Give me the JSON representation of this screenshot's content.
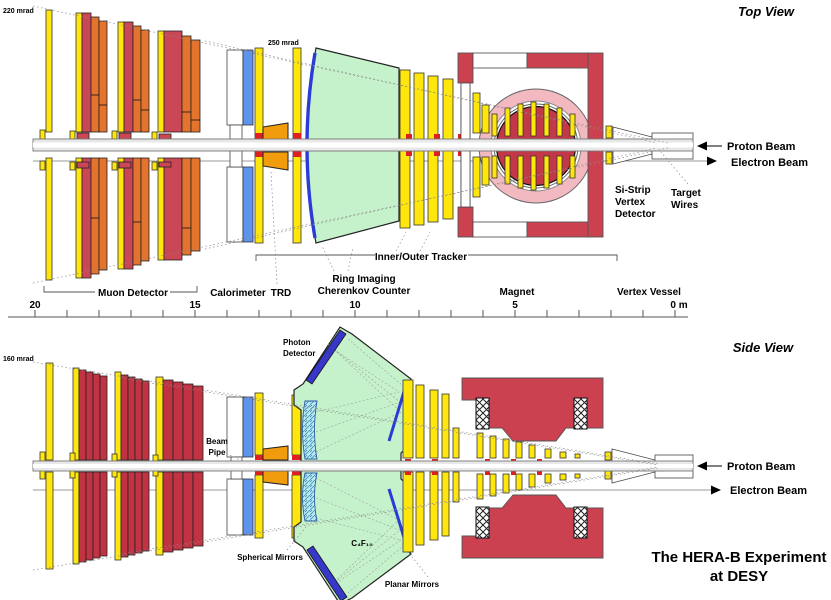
{
  "top": {
    "title": "Top View",
    "angle_outer": "220 mrad",
    "angle_inner": "250 mrad",
    "labels": {
      "muon": "Muon Detector",
      "calorimeter": "Calorimeter",
      "trd": "TRD",
      "rich1": "Ring Imaging",
      "rich2": "Cherenkov Counter",
      "tracker": "Inner/Outer Tracker",
      "magnet": "Magnet",
      "vertex_vessel": "Vertex Vessel",
      "sistrip1": "Si-Strip",
      "sistrip2": "Vertex",
      "sistrip3": "Detector",
      "target1": "Target",
      "target2": "Wires"
    }
  },
  "side": {
    "title": "Side View",
    "angle": "160 mrad",
    "labels": {
      "photon1": "Photon",
      "photon2": "Detector",
      "beampipe1": "Beam",
      "beampipe2": "Pipe",
      "radiator": "C₄F₁₀",
      "spherical": "Spherical Mirrors",
      "planar": "Planar Mirrors"
    }
  },
  "beams": {
    "proton": "Proton Beam",
    "electron": "Electron Beam"
  },
  "scale": {
    "labels": [
      "20",
      "15",
      "10",
      "5",
      "0 m"
    ]
  },
  "caption": {
    "line1": "The HERA-B Experiment",
    "line2": "at DESY"
  },
  "colors": {
    "yellow": "#FFE70D",
    "muon_red_top": "#CC4756",
    "muon_orange_top": "#E4732E",
    "muon_red_side": "#C13243",
    "magnet_red": "#CC4150",
    "ecal_blue": "#5E93EE",
    "trd_orange": "#F09C0C",
    "rich_green": "#C6F2CB",
    "mirror_cyan": "#B8EAF2",
    "photon_detector_blue": "#3838C8",
    "vessel_pink": "#F2BAC0",
    "coil_dome_red": "#C23848",
    "target_purple": "#A13CC0",
    "beam_pipe_gray": "#E8E8E8"
  }
}
